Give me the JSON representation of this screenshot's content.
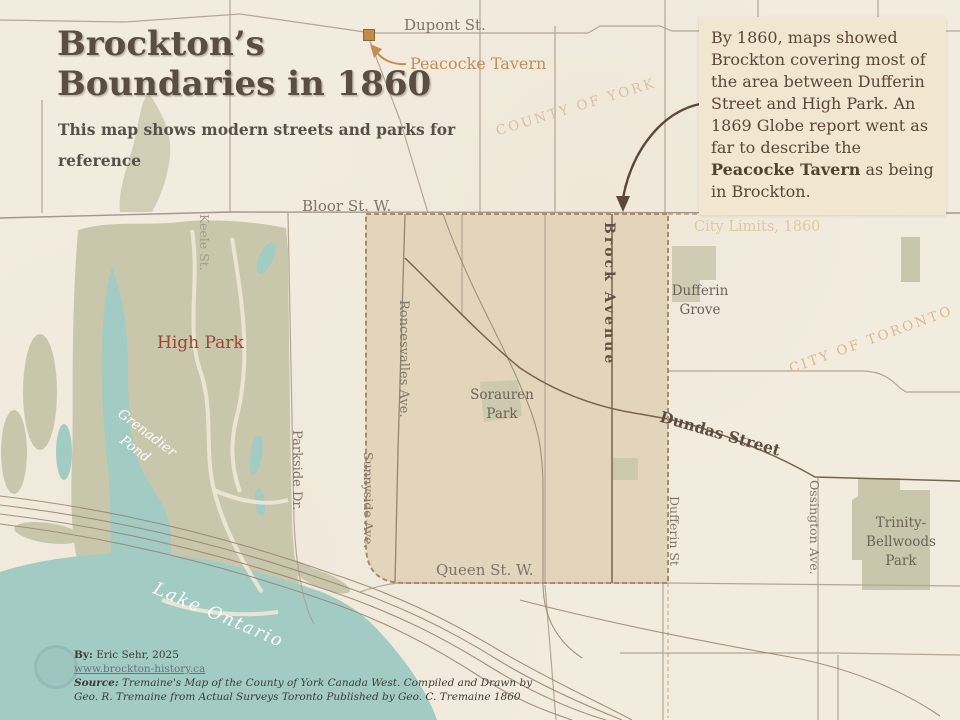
{
  "title": {
    "line1": "Brockton’s",
    "line2": "Boundaries in 1860",
    "subtitle_line1": "This map shows modern streets and parks for",
    "subtitle_line2": "reference"
  },
  "info_box": {
    "text_before": "By 1860, maps showed Brockton covering most of the area between Dufferin Street and High Park. An 1869 Globe report went as far to describe the ",
    "bold_text": "Peacocke Tavern",
    "text_after": " as being in Brockton."
  },
  "streets": {
    "dupont": "Dupont St.",
    "bloor": "Bloor St. W.",
    "queen": "Queen St. W.",
    "dundas": "Dundas Street",
    "brock": "Brock Avenue",
    "roncesvalles": "Roncesvalles Ave.",
    "sunnyside": "Sunnyside Ave.",
    "parkside": "Parkside Dr.",
    "keele": "Keele St.",
    "dufferin": "Dufferin St",
    "ossington": "Ossington Ave."
  },
  "parks": {
    "high_park": "High Park",
    "sorauren": "Sorauren Park",
    "dufferin_grove": "Dufferin Grove",
    "trinity_bellwoods": "Trinity-Bellwoods Park"
  },
  "water": {
    "grenadier_pond": "Grenadier Pond",
    "lake_ontario": "Lake Ontario"
  },
  "annotations": {
    "peacocke_tavern": "Peacocke Tavern",
    "county_of_york": "COUNTY OF YORK",
    "city_of_toronto": "CITY OF TORONTO",
    "city_limits": "City Limits, 1860"
  },
  "attribution": {
    "by_label": "By:",
    "by_text": " Eric Sehr, 2025",
    "url": "www.brockton-history.ca",
    "source_label": "Source:",
    "source_line1": "  Tremaine's Map of the County of York Canada West. Compiled and Drawn by",
    "source_line2": "Geo. R. Tremaine from Actual Surveys Toronto Published by Geo. C. Tremaine 1860"
  },
  "colors": {
    "background": "#f2ecdf",
    "brockton_region_fill": "#e3d4bc",
    "boundary_dash": "#ad8b66",
    "park_green": "#c9c7ab",
    "water_teal": "#a2cbc4",
    "info_box_bg": "#f1e7d0",
    "title_text": "#594e41",
    "street_label": "#7e7569",
    "high_park_label": "#9c4536",
    "peacocke_label": "#c28e55",
    "faded_annotation": "#d7c0a5",
    "arrow": "#5c483a"
  }
}
